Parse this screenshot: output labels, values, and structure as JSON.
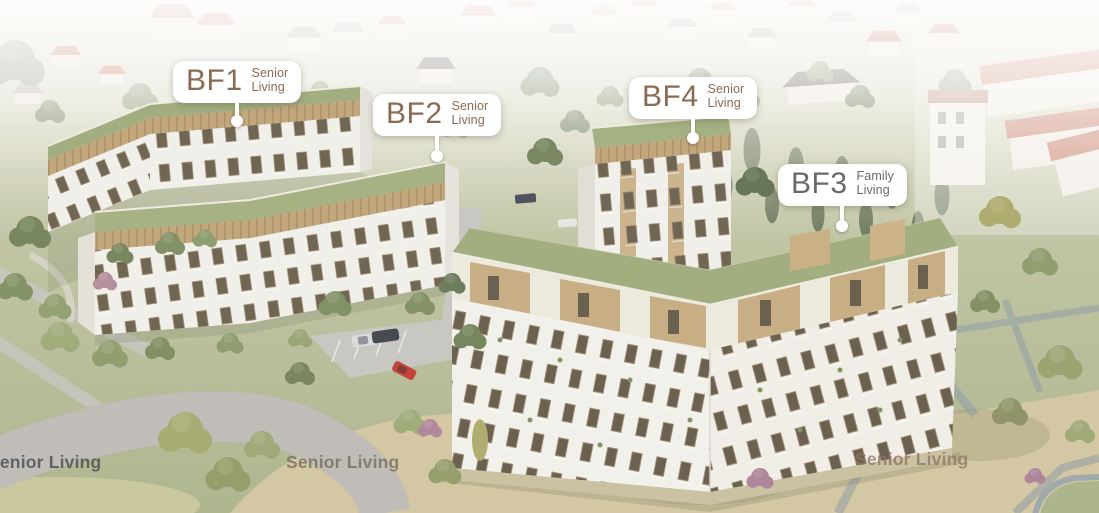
{
  "markers": [
    {
      "id": "BF1",
      "type_line1": "Senior",
      "type_line2": "Living",
      "category": "Senior Living",
      "text_color": "#8a6a52"
    },
    {
      "id": "BF2",
      "type_line1": "Senior",
      "type_line2": "Living",
      "category": "Senior Living",
      "text_color": "#8a6a52"
    },
    {
      "id": "BF3",
      "type_line1": "Family",
      "type_line2": "Living",
      "category": "Family Living",
      "text_color": "#66696e"
    },
    {
      "id": "BF4",
      "type_line1": "Senior",
      "type_line2": "Living",
      "category": "Senior Living",
      "text_color": "#8a6a52"
    }
  ],
  "ground_labels": [
    {
      "text": "Senior Living"
    },
    {
      "text": "Senior Living"
    },
    {
      "text": "Senior Living"
    }
  ],
  "colors": {
    "label_background": "#ffffff",
    "senior_label_text": "#8a6a52",
    "family_label_text": "#66696e",
    "green_roof": "#a2ad82",
    "wood_facade": "#c2a87c",
    "white_facade": "#f2f1ec",
    "background_red_roof": "#b85e46"
  }
}
